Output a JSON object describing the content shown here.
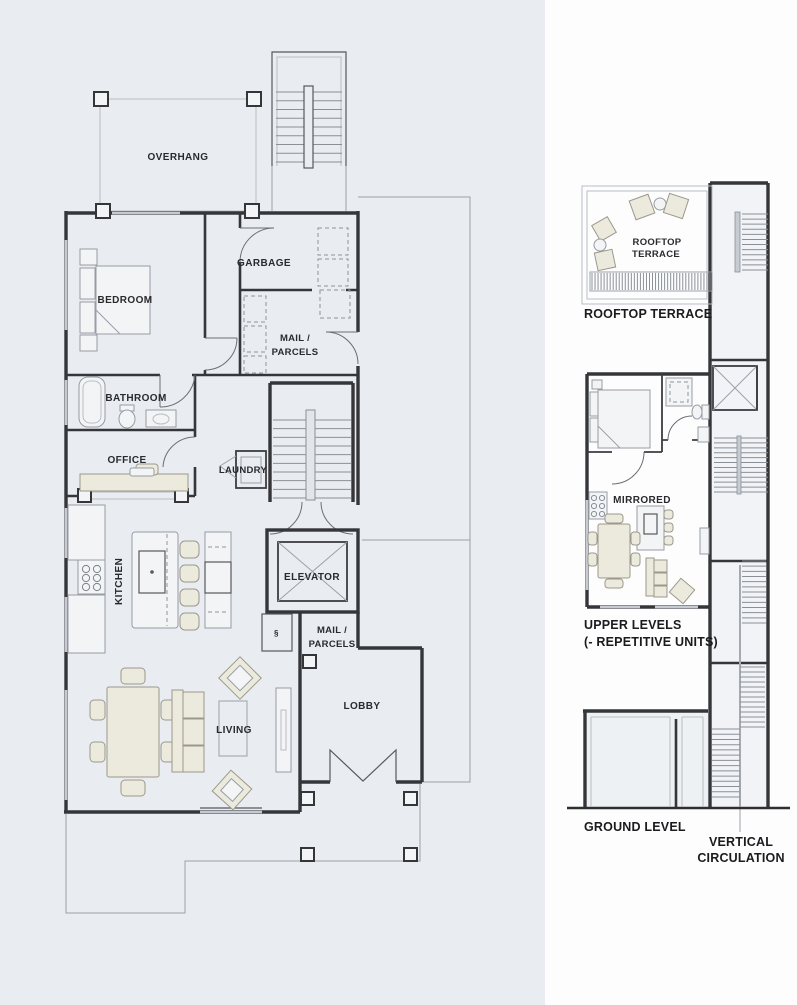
{
  "palette": {
    "plan_background": "#e9edf1",
    "diagram_background": "#fdfdfe",
    "wall": "#35363a",
    "thin_line": "#9aa1a9",
    "window": "#c6cbd3",
    "furniture_fill": "#ece9dd",
    "furniture_light": "#f3f4f6",
    "label_color": "#2a2a2e"
  },
  "ground_floor_plan": {
    "labels": {
      "overhang": "OVERHANG",
      "bedroom": "BEDROOM",
      "garbage": "GARBAGE",
      "mail_parcels_room_line1": "MAIL /",
      "mail_parcels_room_line2": "PARCELS",
      "bathroom": "BATHROOM",
      "office": "OFFICE",
      "laundry": "LAUNDRY",
      "kitchen": "KITCHEN",
      "elevator": "ELEVATOR",
      "mail_parcels_lobby_line1": "MAIL /",
      "mail_parcels_lobby_line2": "PARCELS",
      "living": "LIVING",
      "lobby": "LOBBY"
    }
  },
  "section_diagram": {
    "labels": {
      "terrace_room_line1": "ROOFTOP",
      "terrace_room_line2": "TERRACE",
      "terrace_caption": "ROOFTOP TERRACE",
      "mirrored": "MIRRORED",
      "upper_caption_line1": "UPPER LEVELS",
      "upper_caption_line2": "(- REPETITIVE UNITS)",
      "ground_caption": "GROUND LEVEL",
      "vertical_caption_line1": "VERTICAL",
      "vertical_caption_line2": "CIRCULATION"
    }
  }
}
